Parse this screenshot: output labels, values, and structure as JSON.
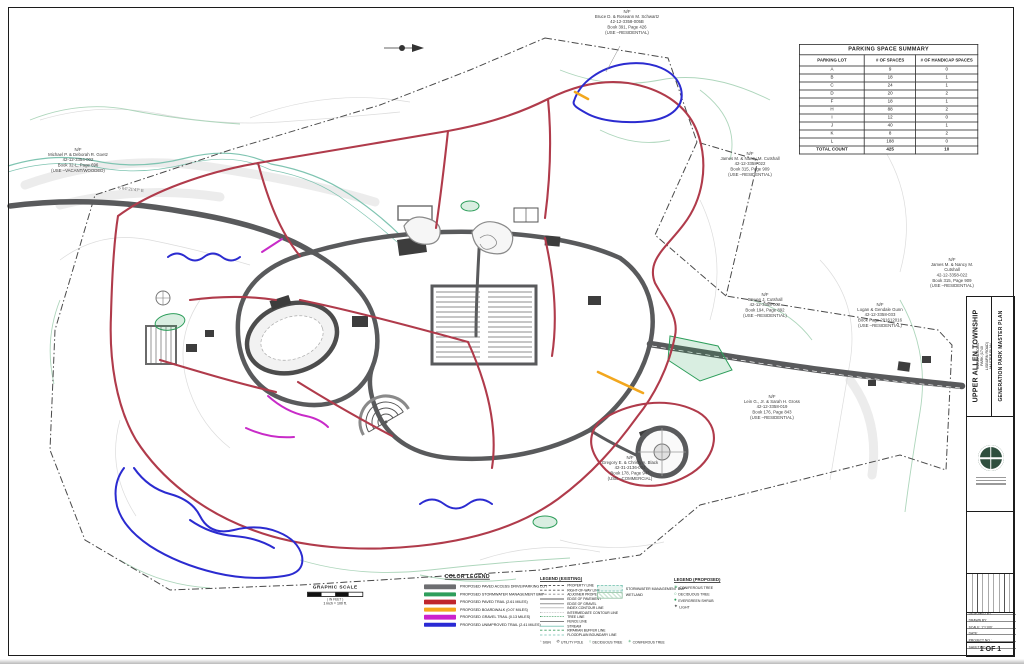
{
  "colors": {
    "paved_access": "#6d6e71",
    "stormwater_bmp": "#2e9e5b",
    "paved_trail": "#b03b4b",
    "boardwalk": "#f2a71e",
    "gravel_trail": "#c82bc8",
    "unimproved_trail": "#2b2bd0",
    "stream": "#7fc4b1",
    "contour_gray": "#dcdcdc",
    "vegetation_green": "#aed6bc"
  },
  "parking_table": {
    "title": "PARKING SPACE SUMMARY",
    "headers": [
      "PARKING LOT",
      "# OF SPACES",
      "# OF HANDICAP SPACES"
    ],
    "rows": [
      [
        "A",
        "9",
        "0"
      ],
      [
        "B",
        "18",
        "1"
      ],
      [
        "C",
        "24",
        "1"
      ],
      [
        "D",
        "20",
        "2"
      ],
      [
        "F",
        "18",
        "1"
      ],
      [
        "H",
        "88",
        "2"
      ],
      [
        "I",
        "12",
        "0"
      ],
      [
        "J",
        "40",
        "1"
      ],
      [
        "K",
        "8",
        "2"
      ],
      [
        "L",
        "188",
        "0"
      ]
    ],
    "total": [
      "TOTAL COUNT",
      "425",
      "10"
    ]
  },
  "graphic_scale": {
    "title": "GRAPHIC SCALE",
    "in_feet": "( IN FEET )",
    "equiv": "1 inch = 100 ft."
  },
  "color_legend": {
    "title": "COLOR LEGEND",
    "items": [
      {
        "label": "PROPOSED PAVED ACCESS DRIVE/PARKING LOT",
        "color": "#6d6e71"
      },
      {
        "label": "PROPOSED STORMWATER MANAGEMENT BMP",
        "color": "#2e9e5b"
      },
      {
        "label": "PROPOSED PAVED TRAIL (2.61 MILES)",
        "color": "#c0272d"
      },
      {
        "label": "PROPOSED BOARDWALK (0.07 MILES)",
        "color": "#f5a81c"
      },
      {
        "label": "PROPOSED GRAVEL TRAIL (0.13 MILES)",
        "color": "#cc22cc"
      },
      {
        "label": "PROPOSED UNIMPROVED TRAIL (2.41 MILES)",
        "color": "#2a2ad4"
      }
    ]
  },
  "legend_existing": {
    "title": "LEGEND (EXISTING)",
    "line_items": [
      "PROPERTY LINE",
      "RIGHT-OF-WAY LINE",
      "ADJOINER PROPERTY LINE",
      "EDGE OF PAVEMENT",
      "EDGE OF GRAVEL",
      "INDEX CONTOUR LINE",
      "INTERMEDIATE CONTOUR LINE",
      "TREE LINE",
      "FENCE LINE",
      "STREAM",
      "RIPARIAN BUFFER LINE",
      "FLOODPLAIN BOUNDARY LINE"
    ],
    "symbol_items": [
      "SIGN",
      "UTILITY POLE",
      "DECIDUOUS TREE",
      "CONIFEROUS TREE"
    ],
    "area_items": [
      "STORMWATER MANAGEMENT BMP",
      "WETLAND"
    ]
  },
  "legend_proposed": {
    "title": "LEGEND (PROPOSED)",
    "items": [
      "CONIFEROUS TREE",
      "DECIDUOUS TREE",
      "EVERGREEN SHRUB",
      "LIGHT"
    ]
  },
  "title_block": {
    "township": "UPPER ALLEN TOWNSHIP",
    "project": "GENERATIONS PARK (1740 LISBURN ROAD)\nMASTER PLAN",
    "sheet_title": "GENERATION PARK MASTER PLAN",
    "fields": [
      "DESIGNED BY:",
      "DRAWN BY:",
      "SCALE:  1\"=100'",
      "DATE:",
      "PROJECT NO.:",
      "SHEET NO.:"
    ],
    "sheet_number": "1 OF 1"
  },
  "map": {
    "bearing_label": "S 64°21'47\" E",
    "property_labels": [
      {
        "text": "N/F\nBruce D. & Roseann M. Schwartz\n42-12-3358-005B\nBook 391, Page 426\n(USE –RESIDENTIAL)"
      },
      {
        "text": "N/F\nMichael P. & Deborah R. Goetz\n42-12-3354-002\nBook 32-L, Page 696\n(USE –VACANT/WOODED)"
      },
      {
        "text": "N/F\nJames M. & Nancy M. Cutshall\n42-12-3358-022\nBook 315, Page 909\n(USE –RESIDENTIAL)"
      },
      {
        "text": "N/F\nJames M. & Nancy M. Cutshall\n42-12-3358-022\nBook 315, Page 909\n(USE –RESIDENTIAL)"
      },
      {
        "text": "N/F\nSteven J. Cutshall\n42-12-3358-002\nBook 194, Page 892\n(USE –RESIDENTIAL)"
      },
      {
        "text": "N/F\nLogan & Gendale Gunn\n42-12-3358-033\nBook Page 201612016\n(USE –RESIDENTIAL)"
      },
      {
        "text": "N/F\nLein G., Jr. & Sarah H. Gross\n42-12-3358-019\nBook 176, Page 843\n(USE –RESIDENTIAL)"
      },
      {
        "text": "N/F\nGregory E. & Christy A. Black\n42-31-2136-004\nBook 178, Page 943\n(USE –COMMERCIAL)"
      }
    ]
  }
}
